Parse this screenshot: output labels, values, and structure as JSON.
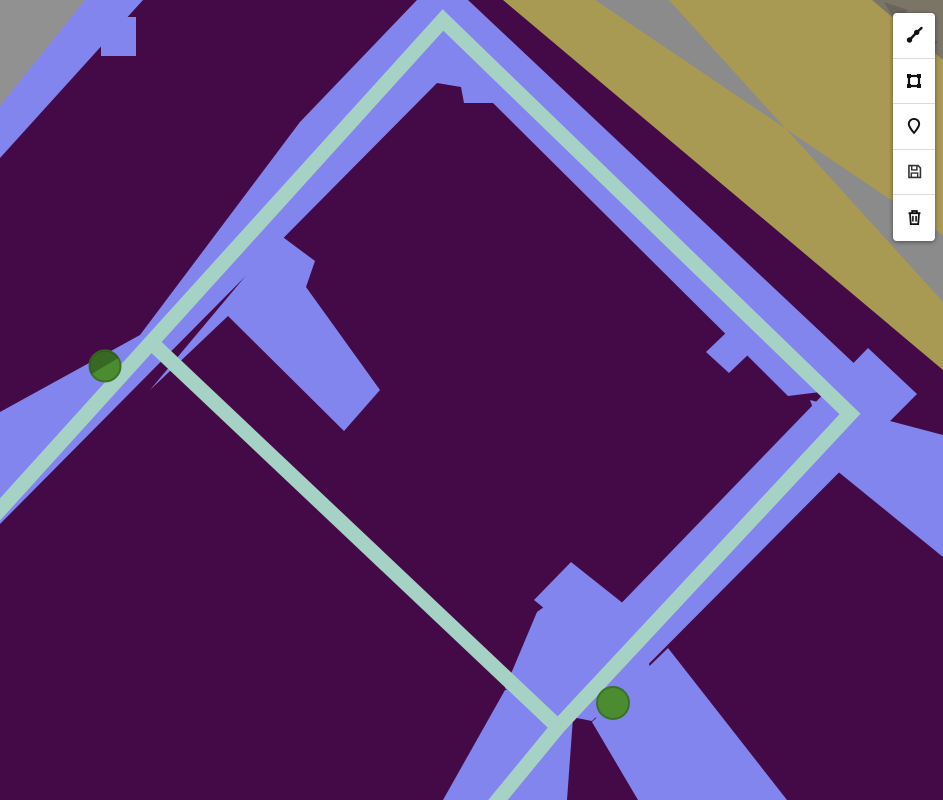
{
  "app": {
    "title": "Map route editor",
    "kind": "interactive map with drawing toolbar"
  },
  "toolbar": {
    "buttons": [
      {
        "name": "draw-polyline",
        "icon": "polyline-icon",
        "tooltip": "Draw polyline"
      },
      {
        "name": "draw-rectangle",
        "icon": "rectangle-icon",
        "tooltip": "Draw rectangle"
      },
      {
        "name": "draw-marker",
        "icon": "marker-icon",
        "tooltip": "Place marker"
      },
      {
        "name": "save",
        "icon": "save-icon",
        "tooltip": "Save"
      },
      {
        "name": "delete",
        "icon": "trash-icon",
        "tooltip": "Delete layers"
      }
    ]
  },
  "map": {
    "width": 943,
    "height": 800,
    "palette": {
      "block": "#440a47",
      "road": "#8285ee",
      "route": "#a6d1c5",
      "land_tan": "#a99a53",
      "band_gray": "#8b8b8b",
      "corner_gray": "#919191",
      "rocky": "#7b7568",
      "rocky_dark": "#6b655a",
      "marker_fill": "#4b8c31",
      "marker_stroke": "#3a7124",
      "marker_shade": "rgba(10,25,5,0.30)"
    },
    "features": [
      {
        "name": "map-background",
        "kind": "rect",
        "x": 0,
        "y": 0,
        "w": 943,
        "h": 800,
        "fill": "block",
        "interactable": false
      },
      {
        "name": "terrain-tan-band",
        "kind": "polygon",
        "fill": "land_tan",
        "interactable": false,
        "points": [
          [
            503,
            0
          ],
          [
            943,
            0
          ],
          [
            943,
            370
          ]
        ]
      },
      {
        "name": "terrain-gray-band",
        "kind": "polygon",
        "fill": "band_gray",
        "interactable": false,
        "points": [
          [
            595,
            0
          ],
          [
            669,
            0
          ],
          [
            943,
            302
          ],
          [
            943,
            235
          ]
        ]
      },
      {
        "name": "terrain-rocky-corner",
        "kind": "polygon",
        "fill": "rocky",
        "interactable": false,
        "points": [
          [
            872,
            0
          ],
          [
            943,
            0
          ],
          [
            943,
            60
          ]
        ]
      },
      {
        "name": "terrain-rocky-texture",
        "kind": "polygon",
        "fill": "rocky_dark",
        "interactable": false,
        "points": [
          [
            884,
            2
          ],
          [
            908,
            10
          ],
          [
            896,
            26
          ],
          [
            915,
            30
          ],
          [
            938,
            42
          ],
          [
            924,
            54
          ],
          [
            906,
            40
          ]
        ]
      },
      {
        "name": "terrain-gray-corner-northwest",
        "kind": "polygon",
        "fill": "corner_gray",
        "interactable": false,
        "points": [
          [
            0,
            0
          ],
          [
            97,
            0
          ],
          [
            0,
            110
          ]
        ]
      },
      {
        "name": "road-northwest",
        "kind": "polygon",
        "fill": "road",
        "interactable": false,
        "points": [
          [
            85,
            0
          ],
          [
            143,
            0
          ],
          [
            0,
            158
          ],
          [
            0,
            106
          ]
        ]
      },
      {
        "name": "road-northwest-spur",
        "kind": "polygon",
        "fill": "road",
        "interactable": false,
        "points": [
          [
            101,
            17
          ],
          [
            136,
            17
          ],
          [
            136,
            56
          ],
          [
            101,
            56
          ]
        ]
      },
      {
        "name": "road-main-loop",
        "kind": "polygon",
        "fill": "road",
        "interactable": false,
        "points": [
          [
            417,
            0
          ],
          [
            468,
            0
          ],
          [
            877,
            385
          ],
          [
            788,
            396
          ],
          [
            493,
            103
          ],
          [
            464,
            103
          ],
          [
            461,
            87
          ],
          [
            437,
            83
          ],
          [
            0,
            524
          ],
          [
            0,
            412
          ],
          [
            140,
            335
          ],
          [
            300,
            122
          ]
        ]
      },
      {
        "name": "road-stub-west",
        "kind": "polygon",
        "fill": "road",
        "interactable": false,
        "points": [
          [
            150,
            390
          ],
          [
            280,
            235
          ],
          [
            315,
            261
          ],
          [
            306,
            287
          ],
          [
            380,
            390
          ],
          [
            344,
            431
          ],
          [
            228,
            316
          ]
        ]
      },
      {
        "name": "road-east-branch",
        "kind": "polygon",
        "fill": "road",
        "interactable": false,
        "points": [
          [
            810,
            400
          ],
          [
            943,
            435
          ],
          [
            943,
            557
          ],
          [
            836,
            470
          ]
        ]
      },
      {
        "name": "road-corner-to-junction",
        "kind": "polygon",
        "fill": "road",
        "interactable": false,
        "points": [
          [
            868,
            348
          ],
          [
            917,
            394
          ],
          [
            592,
            721
          ],
          [
            521,
            707
          ]
        ]
      },
      {
        "name": "road-junction-flare",
        "kind": "polygon",
        "fill": "road",
        "interactable": false,
        "points": [
          [
            505,
            688
          ],
          [
            537,
            612
          ],
          [
            578,
            582
          ],
          [
            642,
            624
          ],
          [
            652,
            680
          ],
          [
            600,
            718
          ],
          [
            528,
            712
          ]
        ]
      },
      {
        "name": "road-stub-south",
        "kind": "polygon",
        "fill": "road",
        "interactable": false,
        "points": [
          [
            534,
            600
          ],
          [
            571,
            562
          ],
          [
            644,
            620
          ],
          [
            606,
            659
          ]
        ]
      },
      {
        "name": "road-southwest-arm",
        "kind": "polygon",
        "fill": "road",
        "interactable": false,
        "points": [
          [
            443,
            800
          ],
          [
            505,
            690
          ],
          [
            575,
            690
          ],
          [
            567,
            800
          ]
        ]
      },
      {
        "name": "road-southeast-arm",
        "kind": "polygon",
        "fill": "road",
        "interactable": false,
        "points": [
          [
            638,
            800
          ],
          [
            592,
            722
          ],
          [
            668,
            648
          ],
          [
            787,
            800
          ]
        ]
      },
      {
        "name": "road-stub-east",
        "kind": "polygon",
        "fill": "road",
        "interactable": false,
        "points": [
          [
            706,
            352
          ],
          [
            752,
            308
          ],
          [
            775,
            329
          ],
          [
            729,
            373
          ]
        ]
      },
      {
        "name": "route-line",
        "kind": "path",
        "stroke": "route",
        "stroke_width": 15,
        "interactable": true,
        "d": "M -6 516 L 443 20 L 850 414 L 558 727 L 493 806"
      },
      {
        "name": "route-diagonal",
        "kind": "path",
        "stroke": "route",
        "stroke_width": 15,
        "interactable": true,
        "d": "M 156 347 L 558 727"
      },
      {
        "name": "waypoint-marker-west",
        "kind": "circle",
        "cx": 105,
        "cy": 366,
        "r": 15.5,
        "fill": "marker_fill",
        "stroke": "marker_stroke",
        "stroke_width": 2,
        "interactable": true
      },
      {
        "name": "waypoint-marker-west-shade",
        "kind": "path",
        "fill": "marker_shade",
        "interactable": false,
        "d": "M 91.7 374 A 15.5 15.5 0 0 1 118.3 358 Z"
      },
      {
        "name": "waypoint-marker-south",
        "kind": "circle",
        "cx": 613,
        "cy": 703,
        "r": 16,
        "fill": "marker_fill",
        "stroke": "marker_stroke",
        "stroke_width": 2,
        "interactable": true
      }
    ]
  }
}
